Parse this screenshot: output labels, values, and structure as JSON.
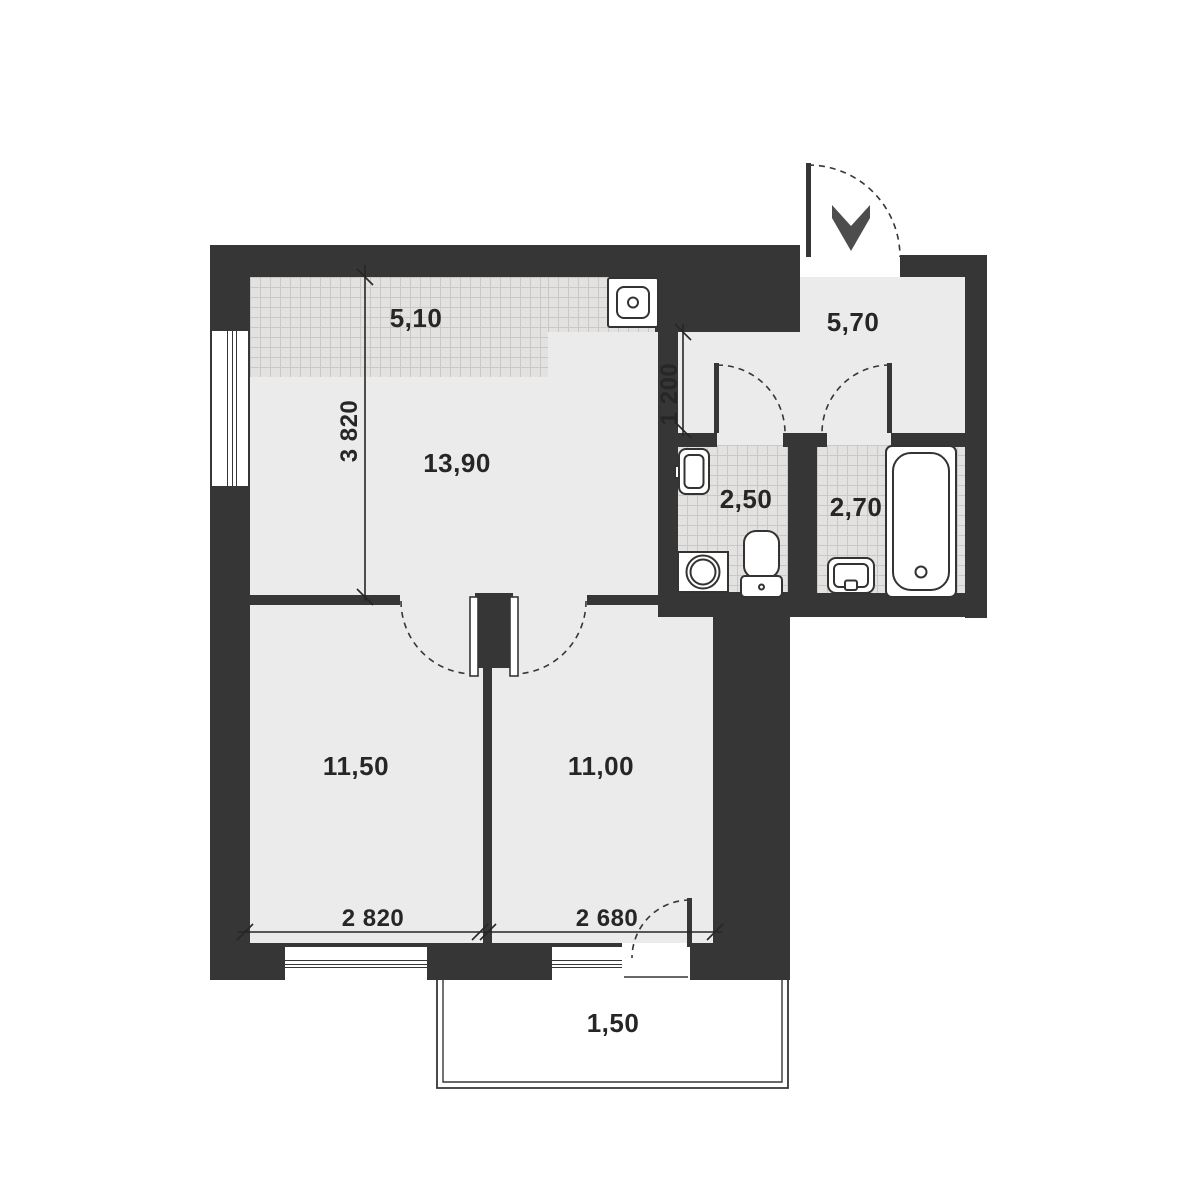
{
  "colors": {
    "wall": "#363636",
    "floor": "#ebebeb",
    "tileBg": "#e3e2e0",
    "tileLine": "#c9c8c6",
    "text": "#262626",
    "arrow": "#4d4d4d",
    "fixture": "#333333"
  },
  "rooms": {
    "kitchen": {
      "label": "5,10"
    },
    "living": {
      "label": "13,90"
    },
    "hallway": {
      "label": "5,70"
    },
    "wc": {
      "label": "2,50"
    },
    "bathroom": {
      "label": "2,70"
    },
    "bedroom1": {
      "label": "11,50"
    },
    "bedroom2": {
      "label": "11,00"
    },
    "balcony": {
      "label": "1,50"
    }
  },
  "dimensions": {
    "living_depth": "3 820",
    "kitchen_passage": "1 200",
    "bedroom1_width": "2 820",
    "bedroom2_width": "2 680"
  },
  "fixtures": [
    "kitchen-sink",
    "wash-basin",
    "washing-machine",
    "toilet",
    "bathroom-sink",
    "bathtub"
  ],
  "entry": {
    "marker": "entrance-arrow"
  }
}
